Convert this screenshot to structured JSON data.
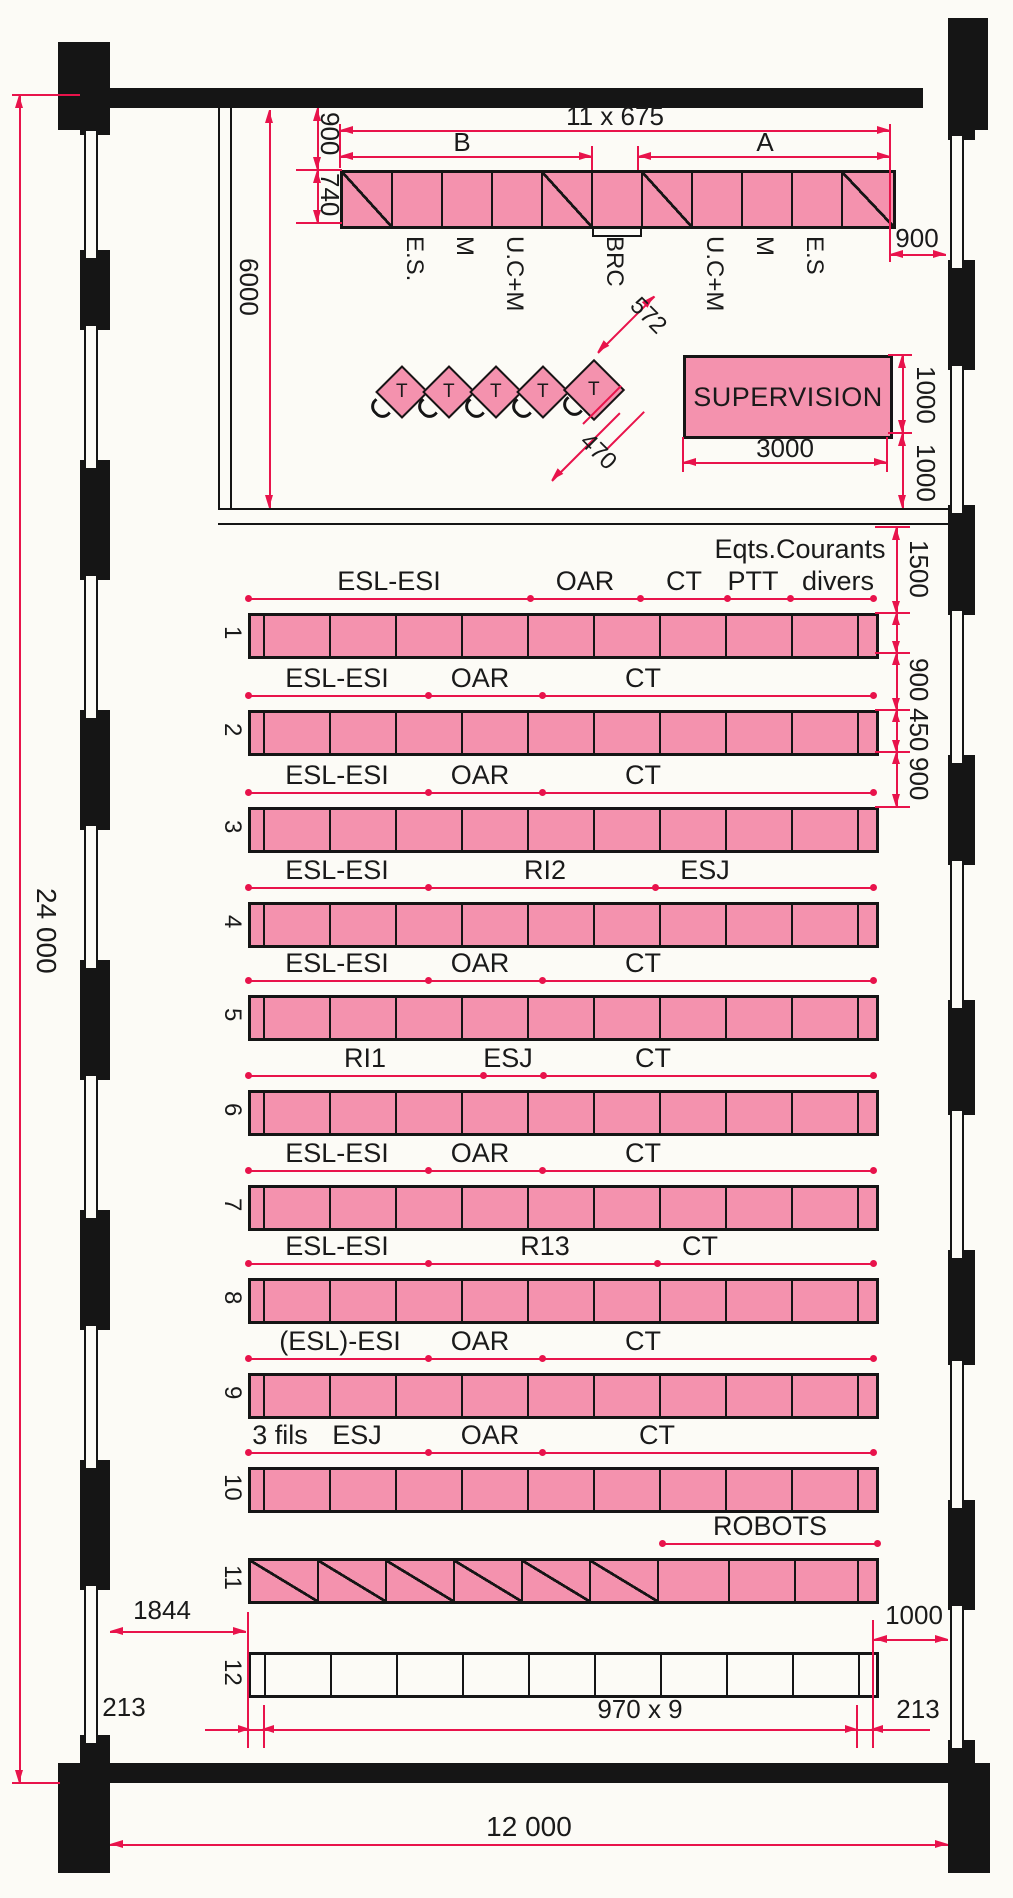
{
  "colors": {
    "pink": "#f492ae",
    "red": "#e8134b",
    "ink": "#151515",
    "paper": "#fcfbf6"
  },
  "top_unit": {
    "dim_above": "900",
    "dim_depth": "740",
    "dim_total": "11 x 675",
    "zone_left": "B",
    "zone_right": "A",
    "dim_right_gap": "900",
    "labels": [
      "E.S.",
      "M",
      "U.C+M",
      "BRC",
      "U.C+M",
      "M",
      "E.S"
    ]
  },
  "upper_room": {
    "dim_depth": "6000",
    "terminal_label": "T",
    "terminal_count": 5,
    "dim_terminal_pitch": "572",
    "dim_terminal_offset": "470",
    "supervision": {
      "label": "SUPERVISION",
      "dim_width": "3000",
      "dim_depth": "1000",
      "dim_gap_below": "1000"
    }
  },
  "right_dims": {
    "labels": [
      "1500",
      "900",
      "450",
      "900"
    ]
  },
  "rows": [
    {
      "number": "1",
      "note": "Eqts.Courants",
      "labels": [
        "ESL-ESI",
        "OAR",
        "CT",
        "PTT",
        "divers"
      ]
    },
    {
      "number": "2",
      "labels": [
        "ESL-ESI",
        "OAR",
        "CT"
      ]
    },
    {
      "number": "3",
      "labels": [
        "ESL-ESI",
        "OAR",
        "CT"
      ]
    },
    {
      "number": "4",
      "labels": [
        "ESL-ESI",
        "RI2",
        "ESJ"
      ]
    },
    {
      "number": "5",
      "labels": [
        "ESL-ESI",
        "OAR",
        "CT"
      ]
    },
    {
      "number": "6",
      "labels": [
        "RI1",
        "ESJ",
        "CT"
      ]
    },
    {
      "number": "7",
      "labels": [
        "ESL-ESI",
        "OAR",
        "CT"
      ]
    },
    {
      "number": "8",
      "labels": [
        "ESL-ESI",
        "R13",
        "CT"
      ]
    },
    {
      "number": "9",
      "labels": [
        "(ESL)-ESI",
        "OAR",
        "CT"
      ]
    },
    {
      "number": "10",
      "labels": [
        "3 fils",
        "ESJ",
        "OAR",
        "CT"
      ]
    },
    {
      "number": "11",
      "labels": [
        "ROBOTS"
      ]
    },
    {
      "number": "12",
      "labels": []
    }
  ],
  "bottom_dims": {
    "left_offset": "1844",
    "cell_left": "213",
    "cells": "970 x 9",
    "cell_right": "213",
    "right_gap": "1000",
    "total_width": "12 000"
  },
  "left_dim": {
    "total_height": "24 000"
  }
}
